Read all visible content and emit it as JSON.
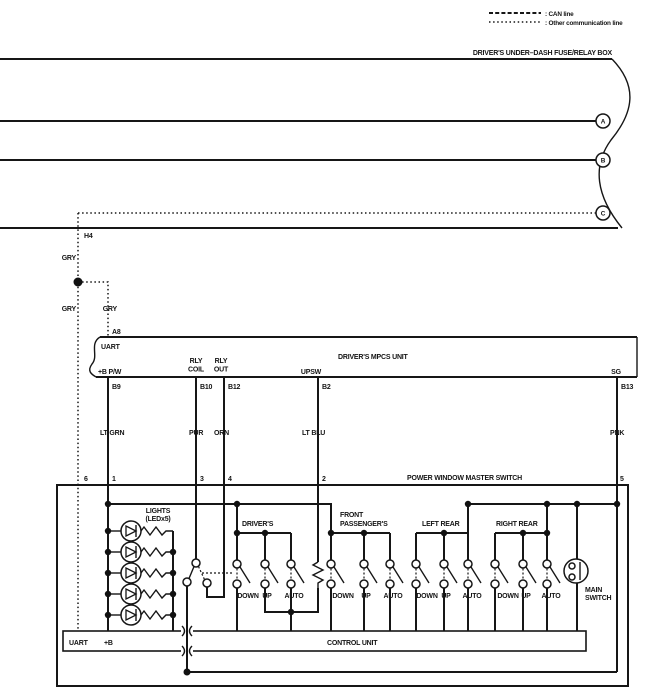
{
  "legend": {
    "can": ": CAN line",
    "other": ": Other communication line"
  },
  "fuse_box": {
    "title": "DRIVER'S UNDER–DASH FUSE/RELAY BOX",
    "terminal_a": "A",
    "terminal_b": "B",
    "terminal_c": "C"
  },
  "junctions": {
    "h4": "H4",
    "a8": "A8",
    "gry_top": "GRY",
    "gry_left": "GRY",
    "gry_right": "GRY"
  },
  "mpcs": {
    "title": "DRIVER'S MPCS UNIT",
    "uart": "UART",
    "b_pw": "+B P/W",
    "rly_coil_1": "RLY",
    "rly_coil_2": "COIL",
    "rly_out_1": "RLY",
    "rly_out_2": "OUT",
    "upsw": "UPSW",
    "sg": "SG",
    "pin_b9": "B9",
    "pin_b10": "B10",
    "pin_b12": "B12",
    "pin_b2": "B2",
    "pin_b13": "B13"
  },
  "wires": {
    "lt_grn": "LT GRN",
    "pur": "PUR",
    "orn": "ORN",
    "lt_blu": "LT BLU",
    "pnk": "PNK"
  },
  "master_switch": {
    "title": "POWER WINDOW MASTER SWITCH",
    "pin_6": "6",
    "pin_1": "1",
    "pin_3": "3",
    "pin_4": "4",
    "pin_2": "2",
    "pin_5": "5",
    "lights": "LIGHTS",
    "lights_sub": "(LEDx5)",
    "drivers": {
      "name": "DRIVER'S",
      "down": "DOWN",
      "up": "UP",
      "auto": "AUTO"
    },
    "front_passengers": {
      "name_1": "FRONT",
      "name_2": "PASSENGER'S",
      "down": "DOWN",
      "up": "UP",
      "auto": "AUTO"
    },
    "left_rear": {
      "name": "LEFT REAR",
      "down": "DOWN",
      "up": "UP",
      "auto": "AUTO"
    },
    "right_rear": {
      "name": "RIGHT REAR",
      "down": "DOWN",
      "up": "UP",
      "auto": "AUTO"
    },
    "main_switch_1": "MAIN",
    "main_switch_2": "SWITCH",
    "control_unit": {
      "label": "CONTROL UNIT",
      "uart": "UART",
      "b": "+B"
    }
  }
}
